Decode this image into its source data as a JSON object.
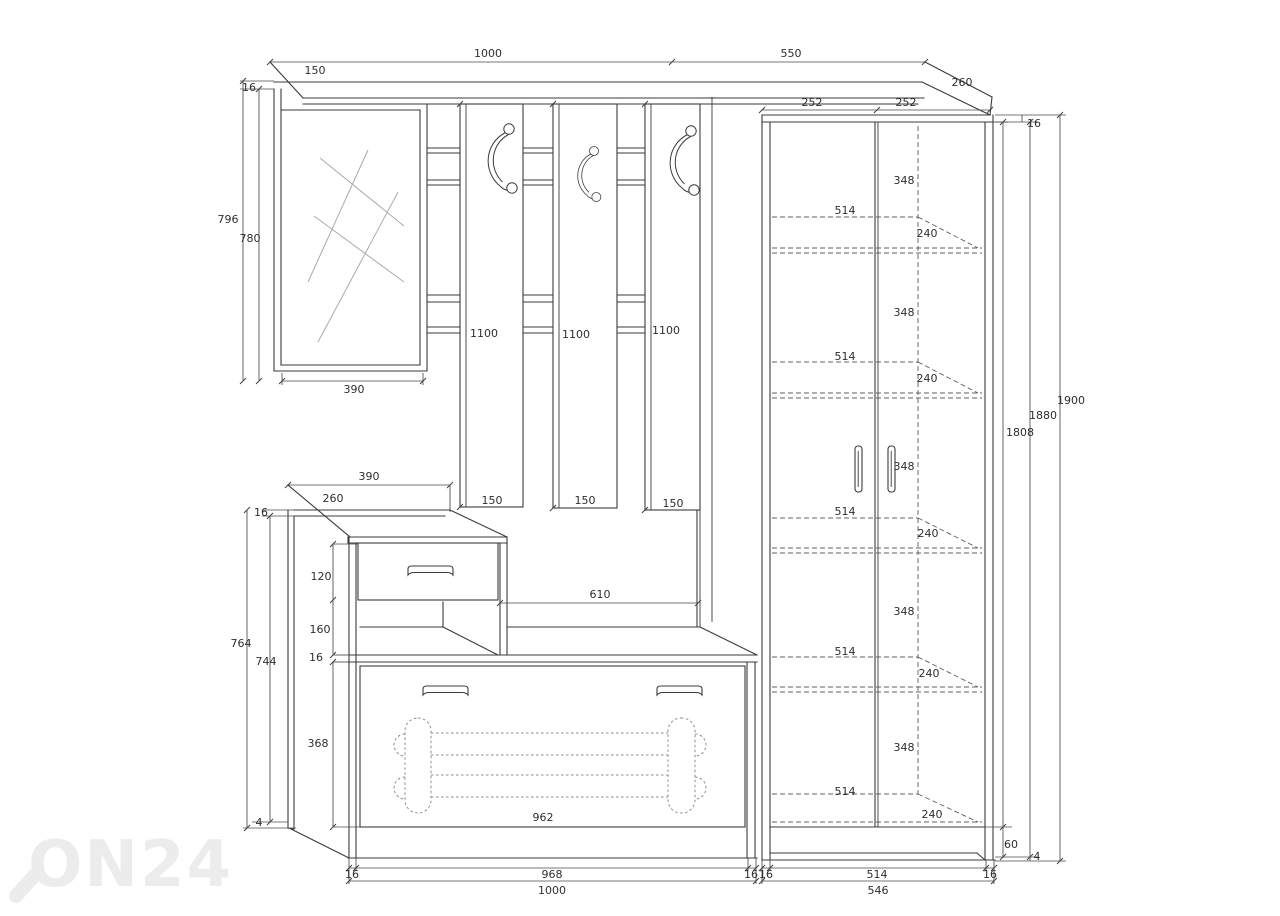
{
  "colors": {
    "line": "#3b3b3b",
    "dimension": "#4a4a4a",
    "watermark": "#ececec",
    "background": "#ffffff"
  },
  "watermark": {
    "text": "ON24"
  },
  "top": {
    "left_width": "1000",
    "left_depth": "150",
    "left_thickness": "16",
    "right_width": "550",
    "right_depth": "260"
  },
  "mirror": {
    "outer_height": "796",
    "inner_height": "780",
    "width": "390"
  },
  "rack": {
    "clearance": "610",
    "panels": [
      {
        "height": "1100",
        "width": "150"
      },
      {
        "height": "1100",
        "width": "150"
      },
      {
        "height": "1100",
        "width": "150"
      }
    ]
  },
  "bench": {
    "top_width": "390",
    "top_depth": "260",
    "top_thickness": "16",
    "drawer_height": "120",
    "niche_height": "160",
    "seat_thickness": "16",
    "outer_height": "764",
    "inner_height": "744",
    "flap_height": "368",
    "flap_width": "962",
    "side_bottom_gap": "4",
    "base_segments": [
      "16",
      "968",
      "16"
    ],
    "total_width": "1000"
  },
  "wardrobe": {
    "door_widths": [
      "252",
      "252"
    ],
    "top_thickness": "16",
    "interior_height": "1808",
    "carcass_height": "1880",
    "total_height": "1900",
    "plinth_height": "60",
    "bottom_gap": "4",
    "base_segments": [
      "16",
      "514",
      "16"
    ],
    "total_width": "546",
    "shelves": [
      {
        "gap": "348",
        "width": "514",
        "depth": "240"
      },
      {
        "gap": "348",
        "width": "514",
        "depth": "240"
      },
      {
        "gap": "348",
        "width": "514",
        "depth": "240"
      },
      {
        "gap": "348",
        "width": "514",
        "depth": "240"
      },
      {
        "gap": "348",
        "width": "514",
        "depth": "240"
      }
    ]
  }
}
